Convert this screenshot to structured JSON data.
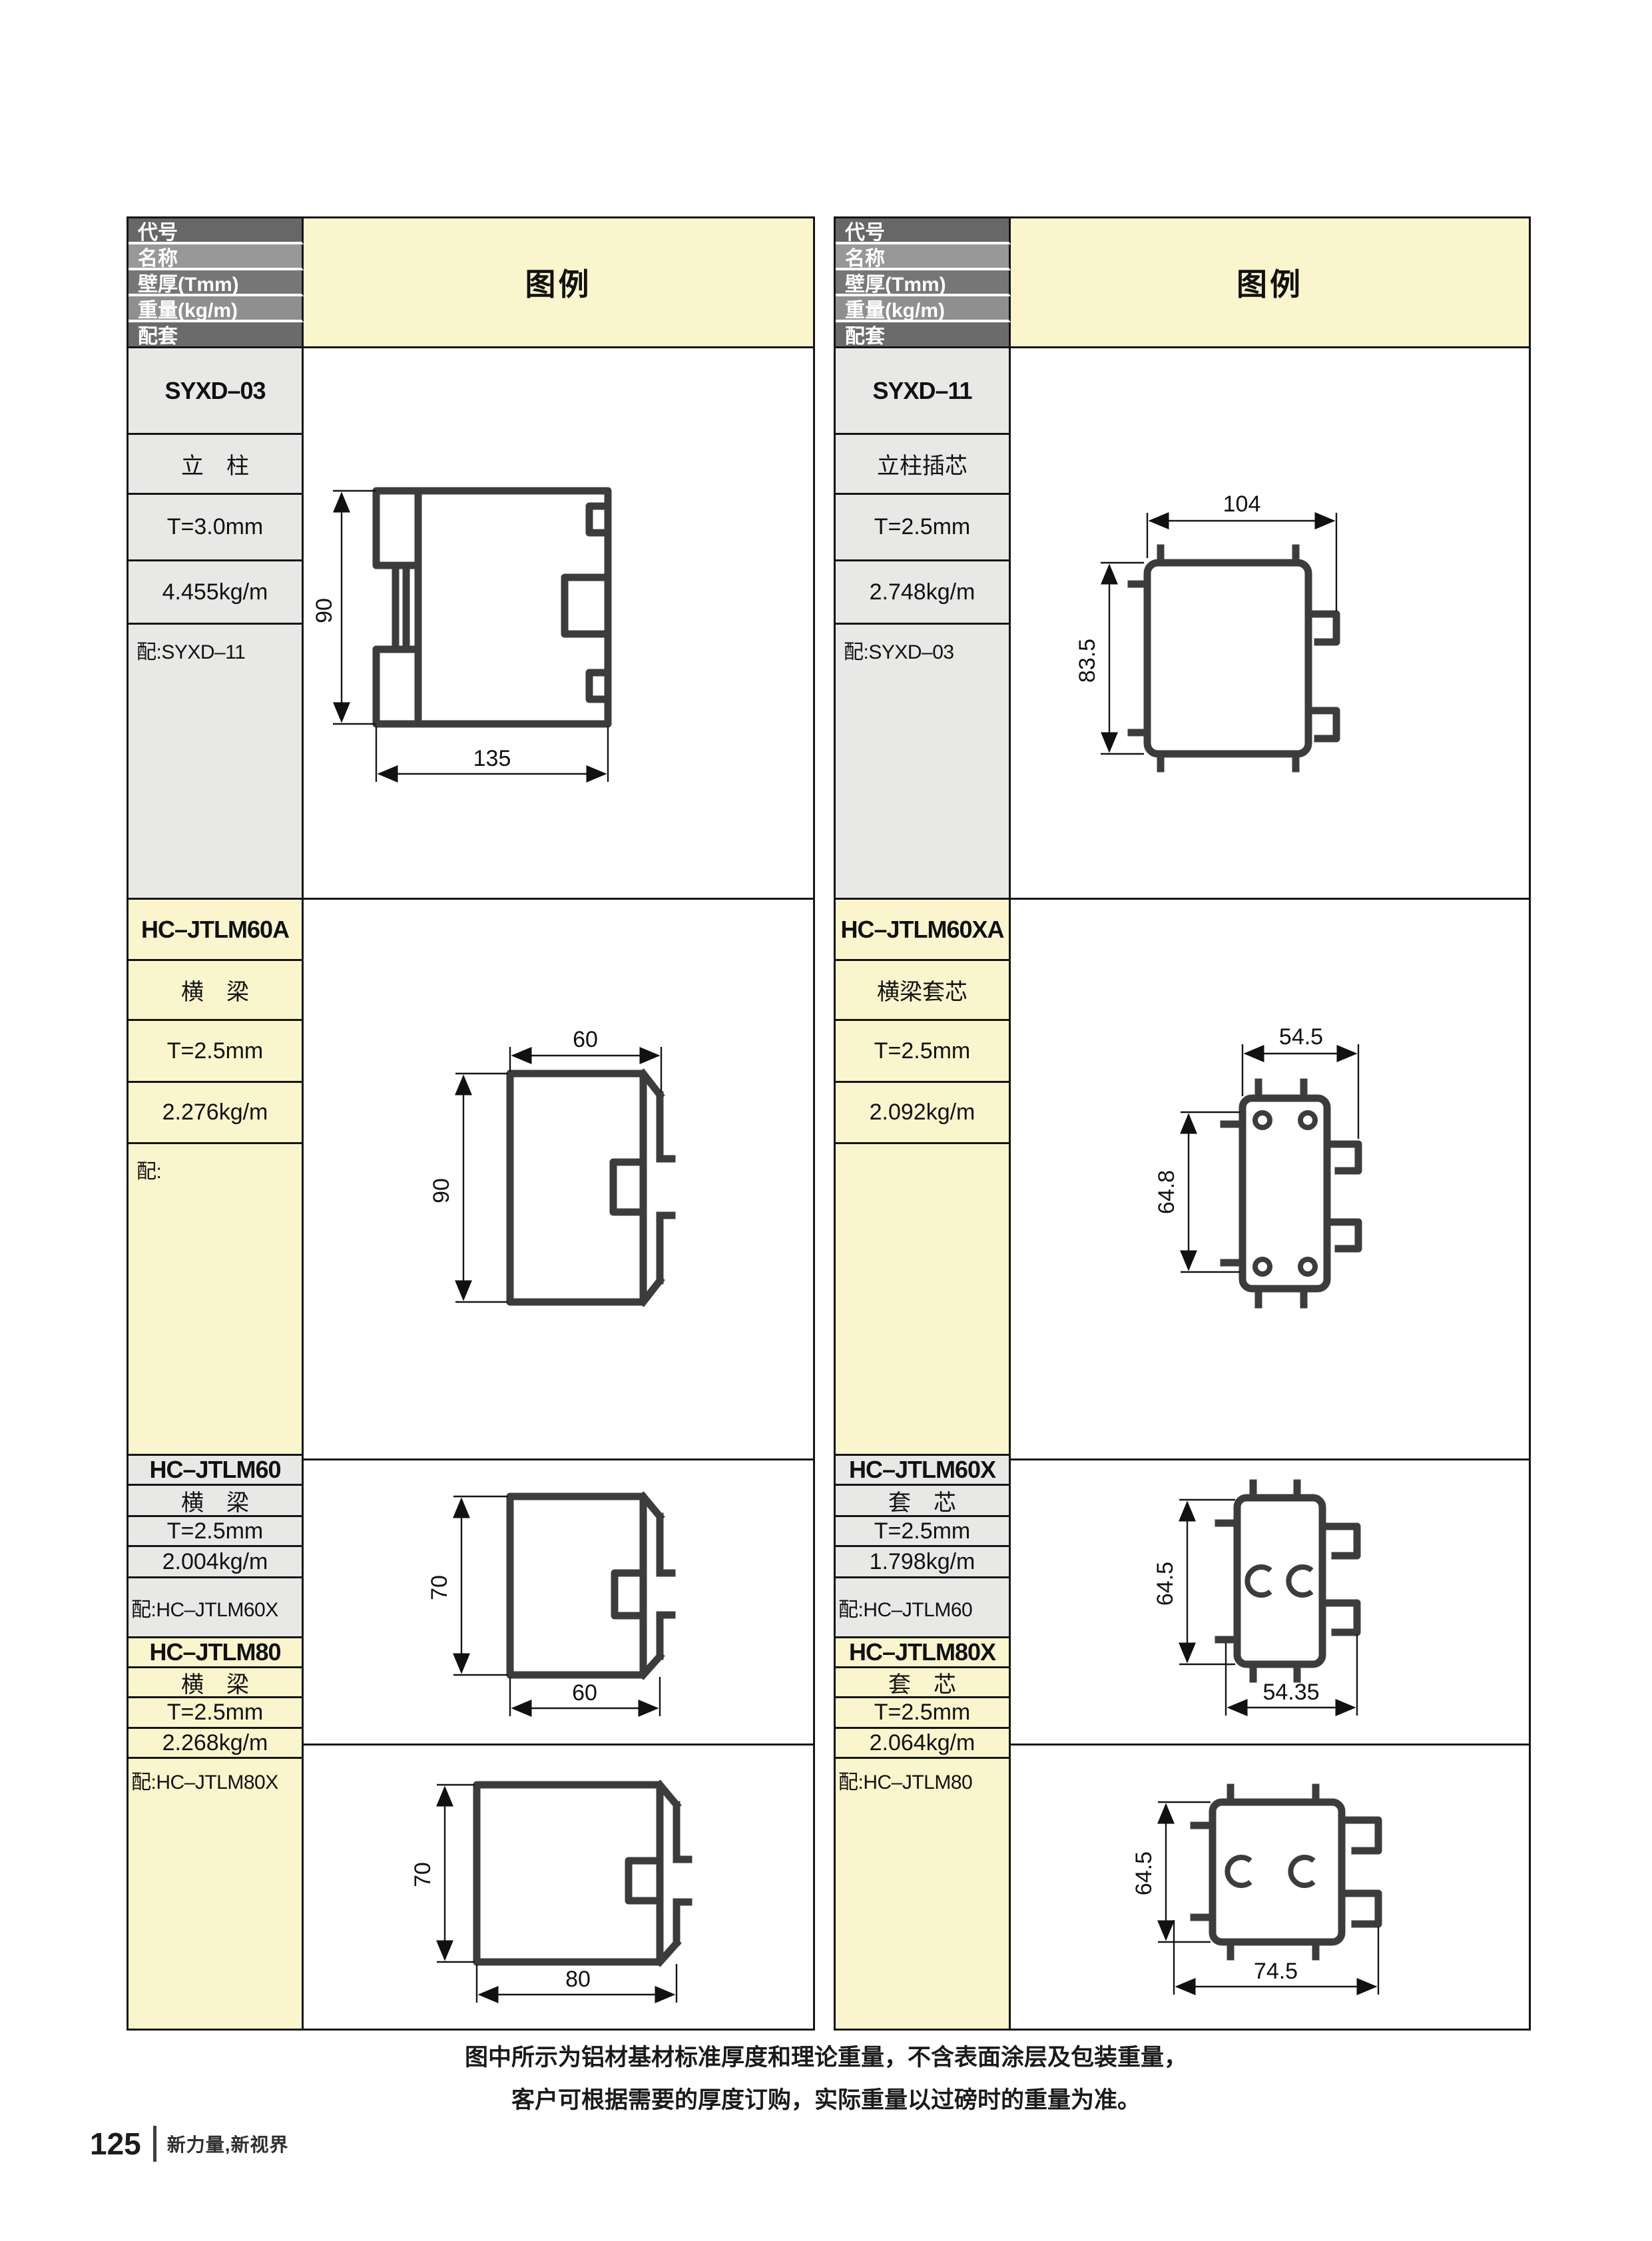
{
  "header_labels": {
    "code": "代号",
    "name": "名称",
    "thickness": "壁厚(Tmm)",
    "weight": "重量(kg/m)",
    "match": "配套",
    "legend": "图例"
  },
  "products": [
    {
      "code": "SYXD–03",
      "name": "立　柱",
      "thickness": "T=3.0mm",
      "weight": "4.455kg/m",
      "match": "配:SYXD–11",
      "dims": {
        "h": "90",
        "w": "135"
      }
    },
    {
      "code": "HC–JTLM60A",
      "name": "横　梁",
      "thickness": "T=2.5mm",
      "weight": "2.276kg/m",
      "match": "配:",
      "dims": {
        "h": "90",
        "w": "60"
      }
    },
    {
      "code": "HC–JTLM60",
      "name": "横　梁",
      "thickness": "T=2.5mm",
      "weight": "2.004kg/m",
      "match": "配:HC–JTLM60X",
      "dims": {
        "h": "70",
        "w": "60"
      }
    },
    {
      "code": "HC–JTLM80",
      "name": "横　梁",
      "thickness": "T=2.5mm",
      "weight": "2.268kg/m",
      "match": "配:HC–JTLM80X",
      "dims": {
        "h": "70",
        "w": "80"
      }
    },
    {
      "code": "SYXD–11",
      "name": "立柱插芯",
      "thickness": "T=2.5mm",
      "weight": "2.748kg/m",
      "match": "配:SYXD–03",
      "dims": {
        "h": "83.5",
        "w": "104"
      }
    },
    {
      "code": "HC–JTLM60XA",
      "name": "横梁套芯",
      "thickness": "T=2.5mm",
      "weight": "2.092kg/m",
      "match": "",
      "dims": {
        "h": "64.8",
        "w": "54.5"
      }
    },
    {
      "code": "HC–JTLM60X",
      "name": "套　芯",
      "thickness": "T=2.5mm",
      "weight": "1.798kg/m",
      "match": "配:HC–JTLM60",
      "dims": {
        "h": "64.5",
        "w": "54.35"
      }
    },
    {
      "code": "HC–JTLM80X",
      "name": "套　芯",
      "thickness": "T=2.5mm",
      "weight": "2.064kg/m",
      "match": "配:HC–JTLM80",
      "dims": {
        "h": "64.5",
        "w": "74.5"
      }
    }
  ],
  "footer": {
    "note_line1": "图中所示为铝材基材标准厚度和理论重量，不含表面涂层及包装重量，",
    "note_line2": "客户可根据需要的厚度订购，实际重量以过磅时的重量为准。",
    "page_number": "125",
    "slogan": "新力量,新视界"
  },
  "colors": {
    "accent_yellow": "#fbf5cd",
    "header_gray_dark": "#676767",
    "header_gray_light": "#989898",
    "block_gray": "#e8e8e7",
    "profile_stroke": "#3c3c3c",
    "border_black": "#151515"
  }
}
